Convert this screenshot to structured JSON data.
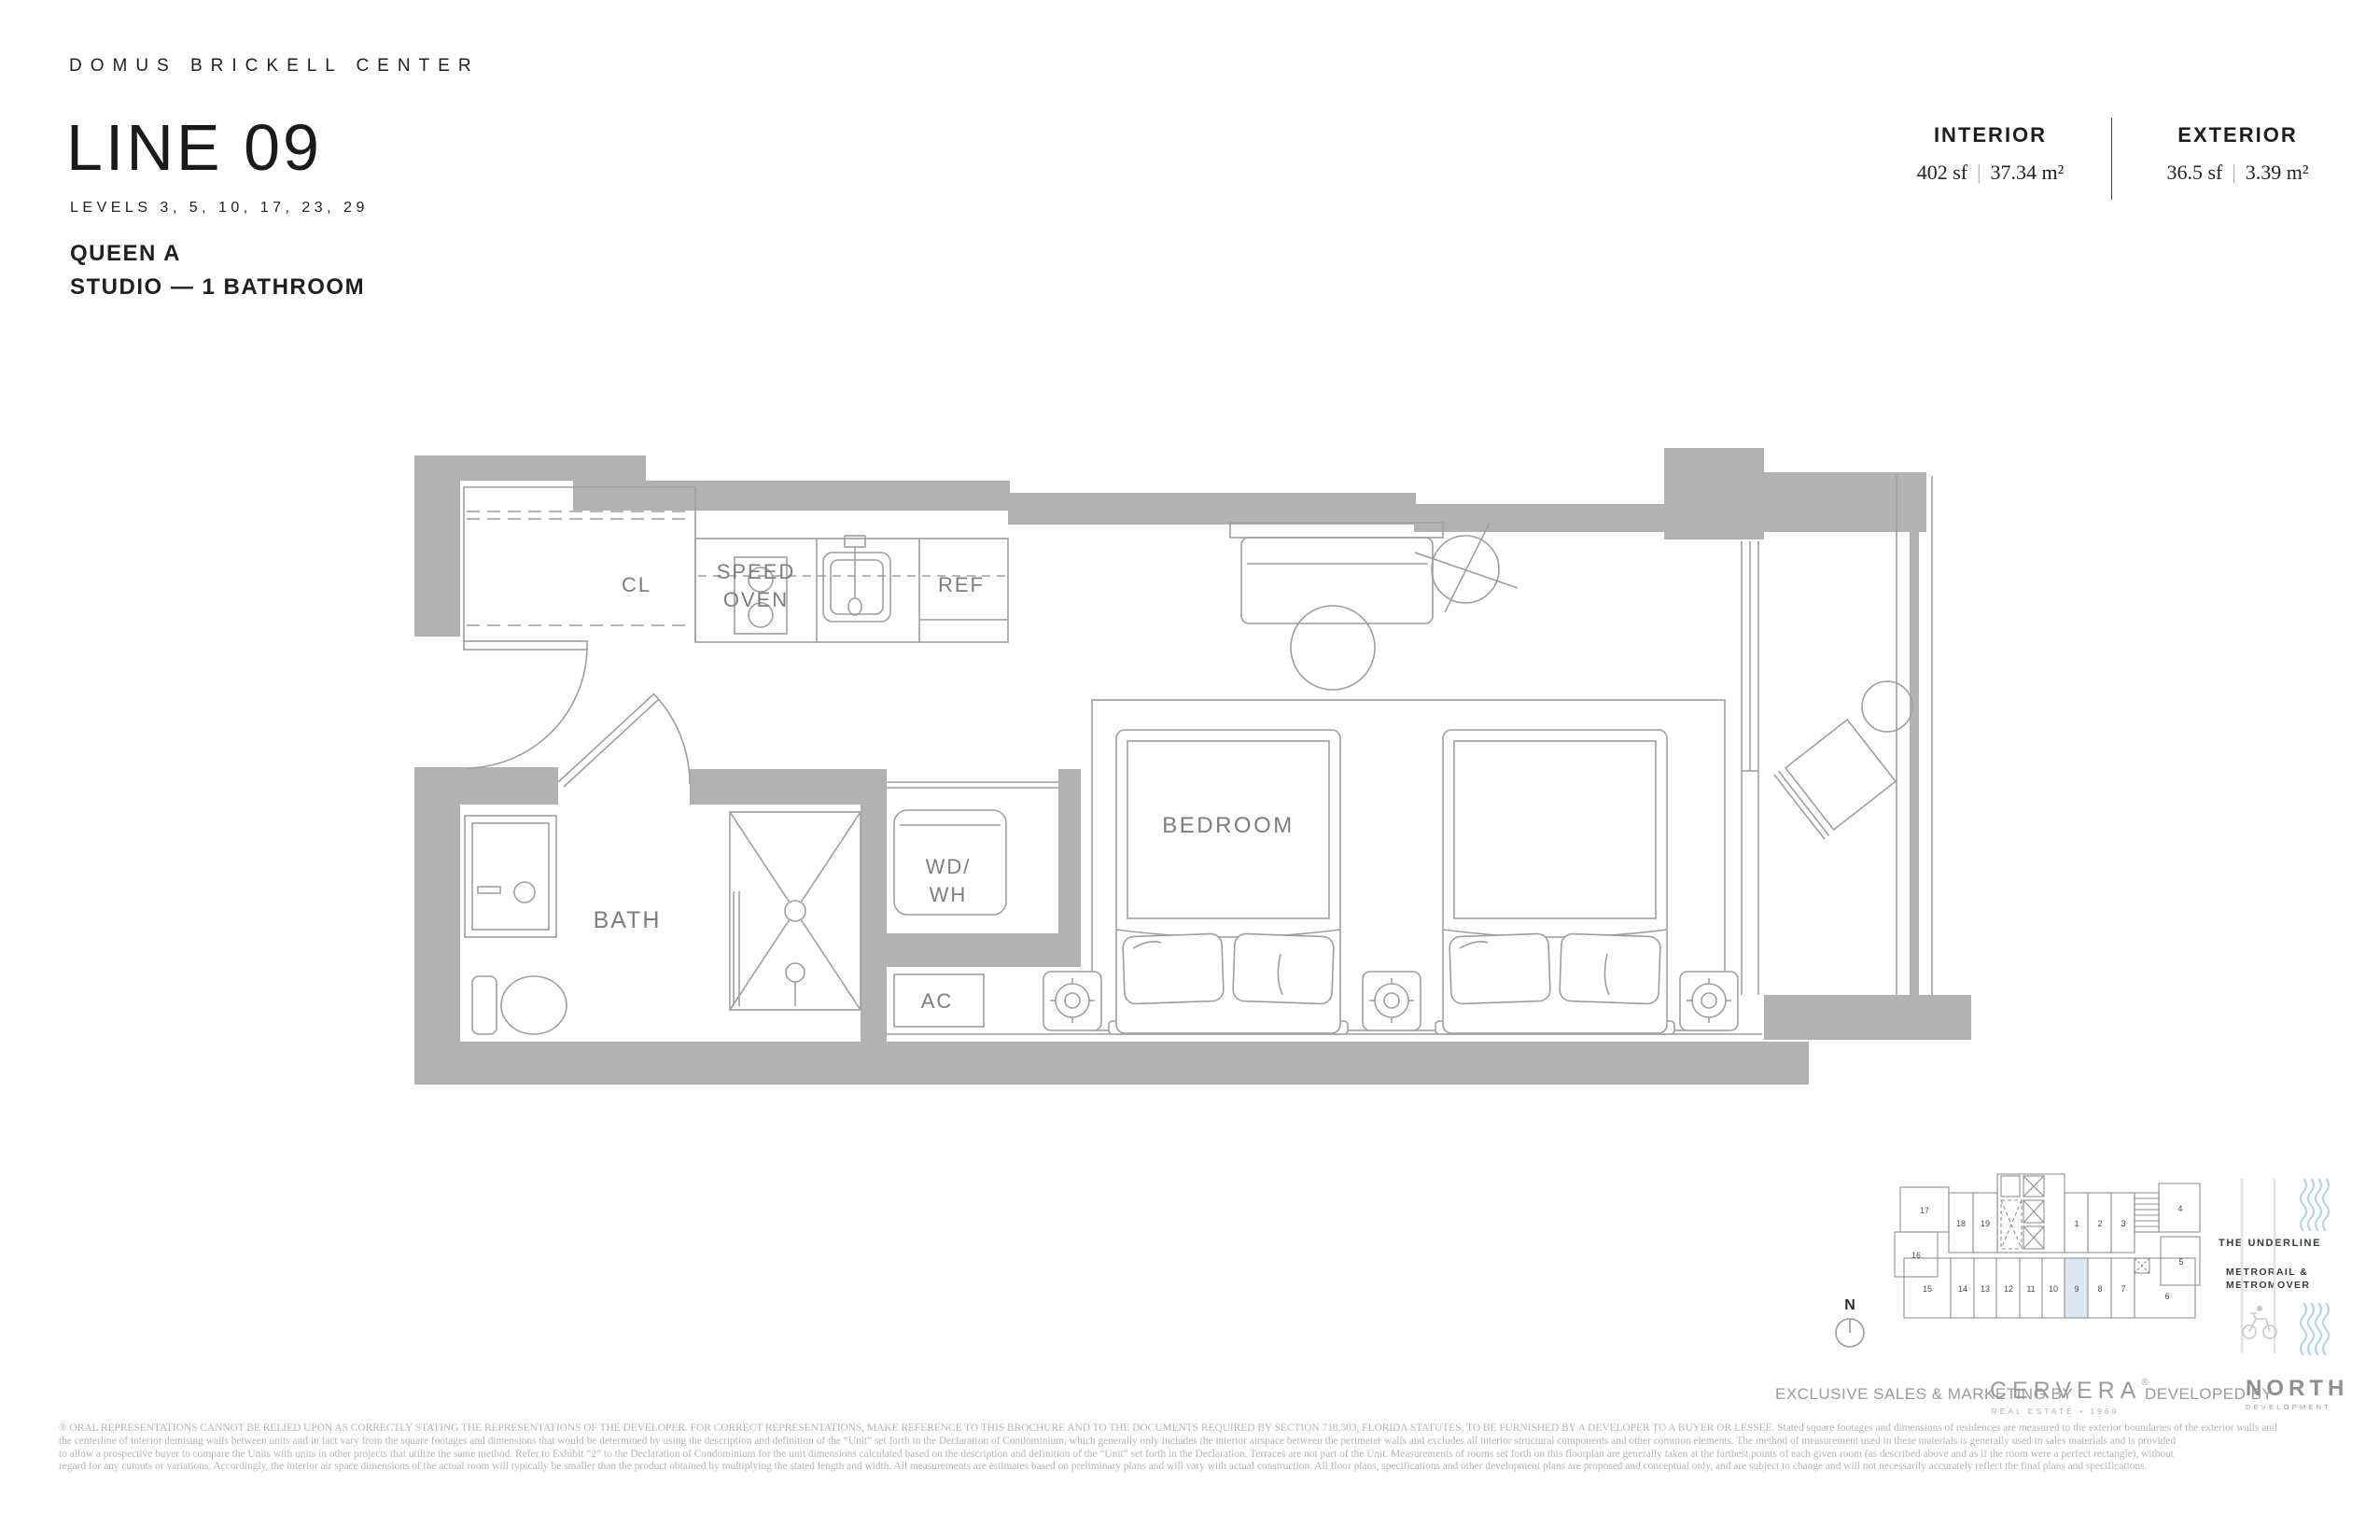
{
  "header": {
    "brand": "DOMUS BRICKELL CENTER",
    "title": "LINE 09",
    "levels": "LEVELS 3, 5, 10, 17, 23, 29",
    "unit_name": "QUEEN A",
    "unit_type": "STUDIO — 1 BATHROOM"
  },
  "stats": {
    "interior": {
      "label": "INTERIOR",
      "sf": "402 sf",
      "divider": "|",
      "sqm": "37.34 m²"
    },
    "exterior": {
      "label": "EXTERIOR",
      "sf": "36.5 sf",
      "divider": "|",
      "sqm": "3.39 m²"
    }
  },
  "plan": {
    "labels": {
      "closet": "CL",
      "speed_oven_line1": "SPEED",
      "speed_oven_line2": "OVEN",
      "fridge": "REF",
      "bath": "BATH",
      "washer_line1": "WD/",
      "washer_line2": "WH",
      "ac": "AC",
      "bedroom": "BEDROOM"
    }
  },
  "keyplan": {
    "north": "N",
    "unit_numbers": [
      "1",
      "2",
      "3",
      "4",
      "5",
      "6",
      "7",
      "8",
      "9",
      "10",
      "11",
      "12",
      "13",
      "14",
      "15",
      "16",
      "17",
      "18",
      "19"
    ],
    "highlighted_unit": "9",
    "highlight_color": "#dce9f2",
    "labels": {
      "underline": "THE UNDERLINE",
      "transit1": "METRORAIL &",
      "transit2": "METROMOVER"
    }
  },
  "footer": {
    "sales_prefix": "EXCLUSIVE SALES & MARKETING BY",
    "cervera_logo": "CERVERA",
    "cervera_reg": "®",
    "cervera_sub": "REAL ESTATE • 1969",
    "developed_prefix": "DEVELOPED BY",
    "north_logo": "NORTH",
    "north_sub": "DEVELOPMENT"
  },
  "disclaimer": {
    "line1": "® ORAL REPRESENTATIONS CANNOT BE RELIED UPON AS CORRECTLY STATING THE REPRESENTATIONS OF THE DEVELOPER. FOR CORRECT REPRESENTATIONS, MAKE REFERENCE TO THIS BROCHURE AND TO THE DOCUMENTS REQUIRED BY SECTION 718.503, FLORIDA STATUTES, TO BE FURNISHED BY A DEVELOPER TO A BUYER OR LESSEE. Stated square footages and dimensions of residences are measured to the exterior boundaries of the exterior walls and",
    "line2": "the centerline of interior demising walls between units and in fact vary from the square footages and dimensions that would be determined by using the description and definition of the “Unit” set forth in the Declaration of Condominium, which generally only includes the interior airspace between the perimeter walls and excludes all interior structural components and other common elements.  The method of measurement used in these materials is generally used in sales materials and is provided",
    "line3": "to allow a prospective buyer to compare the Units with units in other projects that utilize the same method. Refer to Exhibit “2” to the Declaration of Condominium for the unit dimensions calculated based on the description and definition of the “Unit” set forth in the Declaration. Terraces are not part of the Unit.  Measurements of rooms set forth on this floorplan are generally taken at the farthest points of each given room (as described above and as if the room were a perfect rectangle), without",
    "line4": "regard for any cutouts or variations.  Accordingly, the interior air space dimensions of the actual room will typically be smaller than the product obtained by multiplying the stated length and width.  All measurements are estimates based on preliminary plans and will vary with actual construction. All floor plans, specifications and other development plans are proposed and conceptual only, and are subject to change and will not necessarily accurately reflect the final plans and specifications."
  }
}
